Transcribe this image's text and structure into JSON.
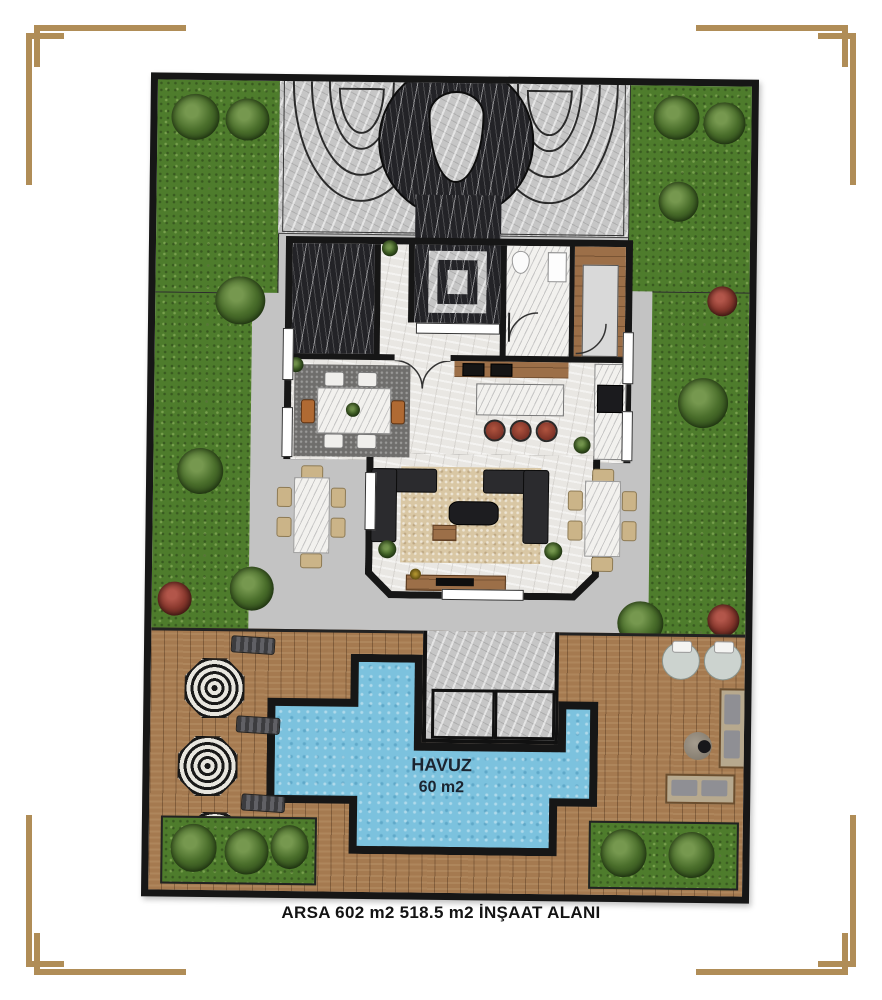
{
  "page": {
    "background": "#ffffff",
    "caption": "ARSA 602 m2  518.5 m2 İNŞAAT ALANI",
    "corner_ornament_color": "#b08d57"
  },
  "plan": {
    "border_color": "#161616",
    "pool": {
      "label": "HAVUZ",
      "area": "60 m2",
      "water_color": "#7cc2de"
    },
    "palette": {
      "grass": "#4e7c2c",
      "pavement": "#c6c6c6",
      "dark_marble": "#232327",
      "interior_floor": "#e9e7e3",
      "deck_wood": "#a57a50",
      "wall": "#161616"
    }
  }
}
